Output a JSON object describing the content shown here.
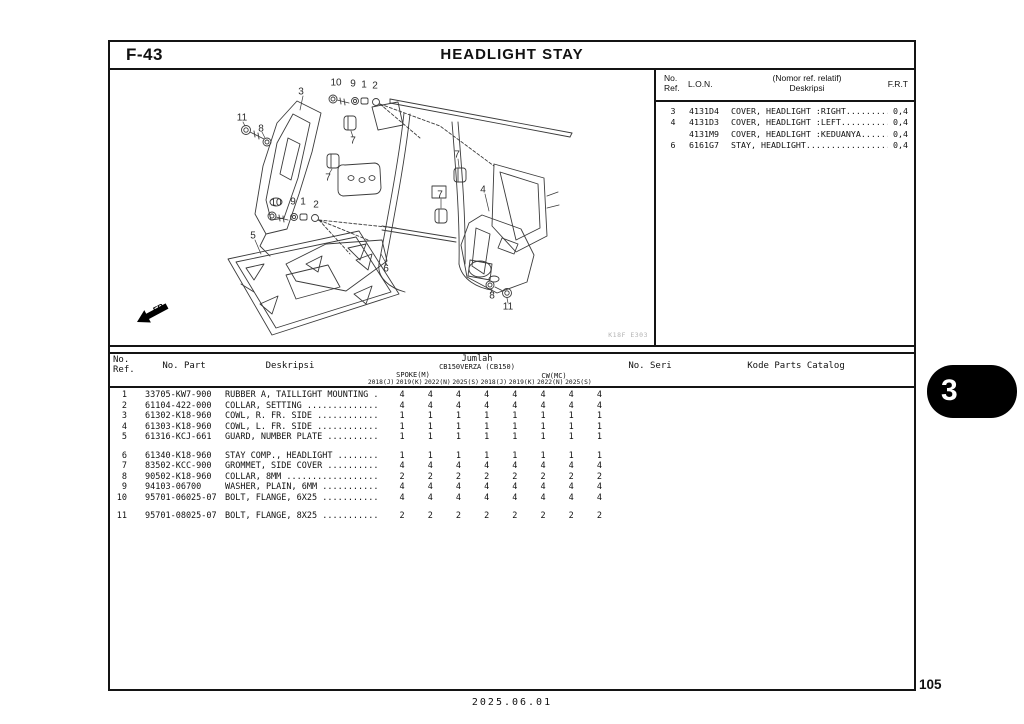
{
  "header": {
    "code": "F-43",
    "title": "HEADLIGHT STAY"
  },
  "ref_table": {
    "headers": {
      "no": "No.",
      "ref": "Ref.",
      "lon": "L.O.N.",
      "desc1": "(Nomor ref. relatif)",
      "desc2": "Deskripsi",
      "frt": "F.R.T"
    },
    "rows": [
      {
        "ref": "3",
        "lon": "4131D4",
        "desc": "COVER, HEADLIGHT :RIGHT..........",
        "frt": "0,4"
      },
      {
        "ref": "4",
        "lon": "4131D3",
        "desc": "COVER, HEADLIGHT :LEFT...........",
        "frt": "0,4"
      },
      {
        "ref": "",
        "lon": "4131M9",
        "desc": "COVER, HEADLIGHT :KEDUANYA.......",
        "frt": "0,4"
      },
      {
        "ref": "6",
        "lon": "6161G7",
        "desc": "STAY, HEADLIGHT..................",
        "frt": "0,4"
      }
    ]
  },
  "parts_table": {
    "headers": {
      "no": "No.",
      "ref": "Ref.",
      "no_part": "No. Part",
      "deskripsi": "Deskripsi",
      "jumlah": "Jumlah",
      "model": "CB150VERZA (CB150)",
      "spoke": "SPOKE(M)",
      "cw": "CW(MC)",
      "years": [
        "2018(J)",
        "2019(K)",
        "2022(N)",
        "2025(S)",
        "2018(J)",
        "2019(K)",
        "2022(N)",
        "2025(S)"
      ],
      "no_seri": "No. Seri",
      "kode": "Kode Parts Catalog"
    },
    "rows": [
      {
        "ref": "1",
        "part": "33705-KW7-900",
        "desc": "RUBBER A, TAILLIGHT MOUNTING .",
        "qty": [
          "4",
          "4",
          "4",
          "4",
          "4",
          "4",
          "4",
          "4"
        ],
        "gap": false
      },
      {
        "ref": "2",
        "part": "61104-422-000",
        "desc": "COLLAR, SETTING ..............",
        "qty": [
          "4",
          "4",
          "4",
          "4",
          "4",
          "4",
          "4",
          "4"
        ],
        "gap": false
      },
      {
        "ref": "3",
        "part": "61302-K18-960",
        "desc": "COWL, R. FR. SIDE ............",
        "qty": [
          "1",
          "1",
          "1",
          "1",
          "1",
          "1",
          "1",
          "1"
        ],
        "gap": false
      },
      {
        "ref": "4",
        "part": "61303-K18-960",
        "desc": "COWL, L. FR. SIDE ............",
        "qty": [
          "1",
          "1",
          "1",
          "1",
          "1",
          "1",
          "1",
          "1"
        ],
        "gap": false
      },
      {
        "ref": "5",
        "part": "61316-KCJ-661",
        "desc": "GUARD, NUMBER PLATE ..........",
        "qty": [
          "1",
          "1",
          "1",
          "1",
          "1",
          "1",
          "1",
          "1"
        ],
        "gap": false
      },
      {
        "ref": "6",
        "part": "61340-K18-960",
        "desc": "STAY COMP., HEADLIGHT ........",
        "qty": [
          "1",
          "1",
          "1",
          "1",
          "1",
          "1",
          "1",
          "1"
        ],
        "gap": true
      },
      {
        "ref": "7",
        "part": "83502-KCC-900",
        "desc": "GROMMET, SIDE COVER ..........",
        "qty": [
          "4",
          "4",
          "4",
          "4",
          "4",
          "4",
          "4",
          "4"
        ],
        "gap": false
      },
      {
        "ref": "8",
        "part": "90502-K18-960",
        "desc": "COLLAR, 8MM ..................",
        "qty": [
          "2",
          "2",
          "2",
          "2",
          "2",
          "2",
          "2",
          "2"
        ],
        "gap": false
      },
      {
        "ref": "9",
        "part": "94103-06700",
        "desc": "WASHER, PLAIN, 6MM ...........",
        "qty": [
          "4",
          "4",
          "4",
          "4",
          "4",
          "4",
          "4",
          "4"
        ],
        "gap": false
      },
      {
        "ref": "10",
        "part": "95701-06025-07",
        "desc": "BOLT, FLANGE, 6X25 ...........",
        "qty": [
          "4",
          "4",
          "4",
          "4",
          "4",
          "4",
          "4",
          "4"
        ],
        "gap": false
      },
      {
        "ref": "11",
        "part": "95701-08025-07",
        "desc": "BOLT, FLANGE, 8X25 ...........",
        "qty": [
          "2",
          "2",
          "2",
          "2",
          "2",
          "2",
          "2",
          "2"
        ],
        "gap": true
      }
    ]
  },
  "diagram": {
    "code": "K18F E303",
    "fr_label": "FR.",
    "callouts": [
      {
        "n": "10",
        "x": 226,
        "y": 13
      },
      {
        "n": "9",
        "x": 243,
        "y": 14
      },
      {
        "n": "1",
        "x": 254,
        "y": 15
      },
      {
        "n": "2",
        "x": 265,
        "y": 16
      },
      {
        "n": "3",
        "x": 191,
        "y": 22
      },
      {
        "n": "11",
        "x": 132,
        "y": 48
      },
      {
        "n": "8",
        "x": 151,
        "y": 59
      },
      {
        "n": "7",
        "x": 243,
        "y": 71
      },
      {
        "n": "7",
        "x": 347,
        "y": 85
      },
      {
        "n": "7",
        "x": 218,
        "y": 108
      },
      {
        "n": "7",
        "x": 330,
        "y": 125
      },
      {
        "n": "4",
        "x": 373,
        "y": 120
      },
      {
        "n": "10",
        "x": 166,
        "y": 133
      },
      {
        "n": "9",
        "x": 183,
        "y": 132
      },
      {
        "n": "1",
        "x": 193,
        "y": 132
      },
      {
        "n": "2",
        "x": 206,
        "y": 135
      },
      {
        "n": "5",
        "x": 143,
        "y": 166
      },
      {
        "n": "6",
        "x": 276,
        "y": 199
      },
      {
        "n": "8",
        "x": 382,
        "y": 226
      },
      {
        "n": "11",
        "x": 398,
        "y": 237
      }
    ]
  },
  "footer": {
    "date": "2025.06.01",
    "page": "105",
    "tab": "3"
  }
}
